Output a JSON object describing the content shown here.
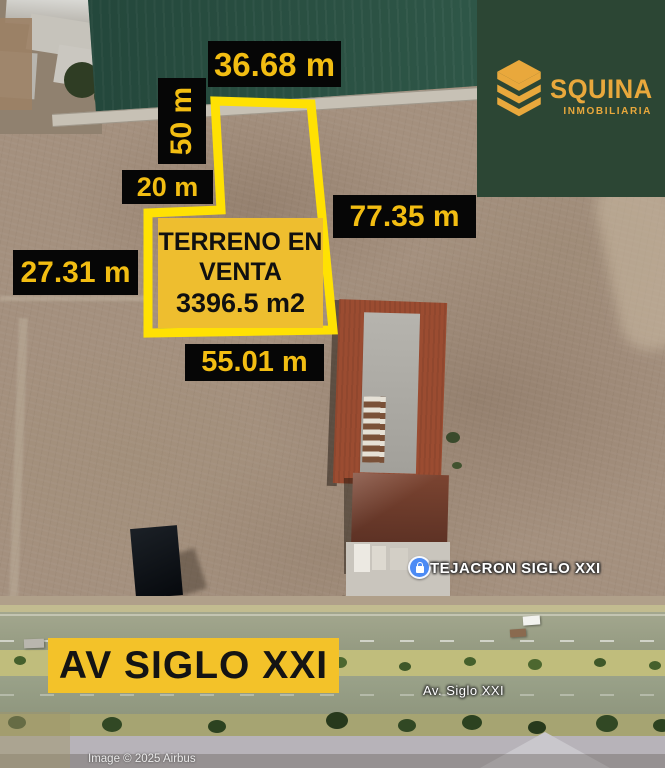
{
  "brand": {
    "name": "SQUINA",
    "tagline": "INMOBILIARIA"
  },
  "measurements": {
    "top": "36.68 m",
    "left_vertical": "50 m",
    "notch": "20 m",
    "right": "77.35 m",
    "left": "27.31 m",
    "bottom": "55.01 m"
  },
  "listing": {
    "title_line1": "TERRENO EN",
    "title_line2": "VENTA",
    "area": "3396.5 m2"
  },
  "banner": {
    "text": "AV SIGLO XXI"
  },
  "map": {
    "place_label": "TEJACRON SIGLO XXI",
    "road_label": "Av. Siglo XXI",
    "attribution": "Image © 2025 Airbus"
  },
  "colors": {
    "label_background": "#060606",
    "label_text_gold": "#F2BD12",
    "parcel_outline_yellow": "#FFE103",
    "listing_panel_gold": "#EEBE2F",
    "banner_gold": "#F3C229",
    "logo_panel_green": "#2C4634",
    "logo_gold": "#E9A83C",
    "place_pin_blue": "#4C8BF5"
  }
}
